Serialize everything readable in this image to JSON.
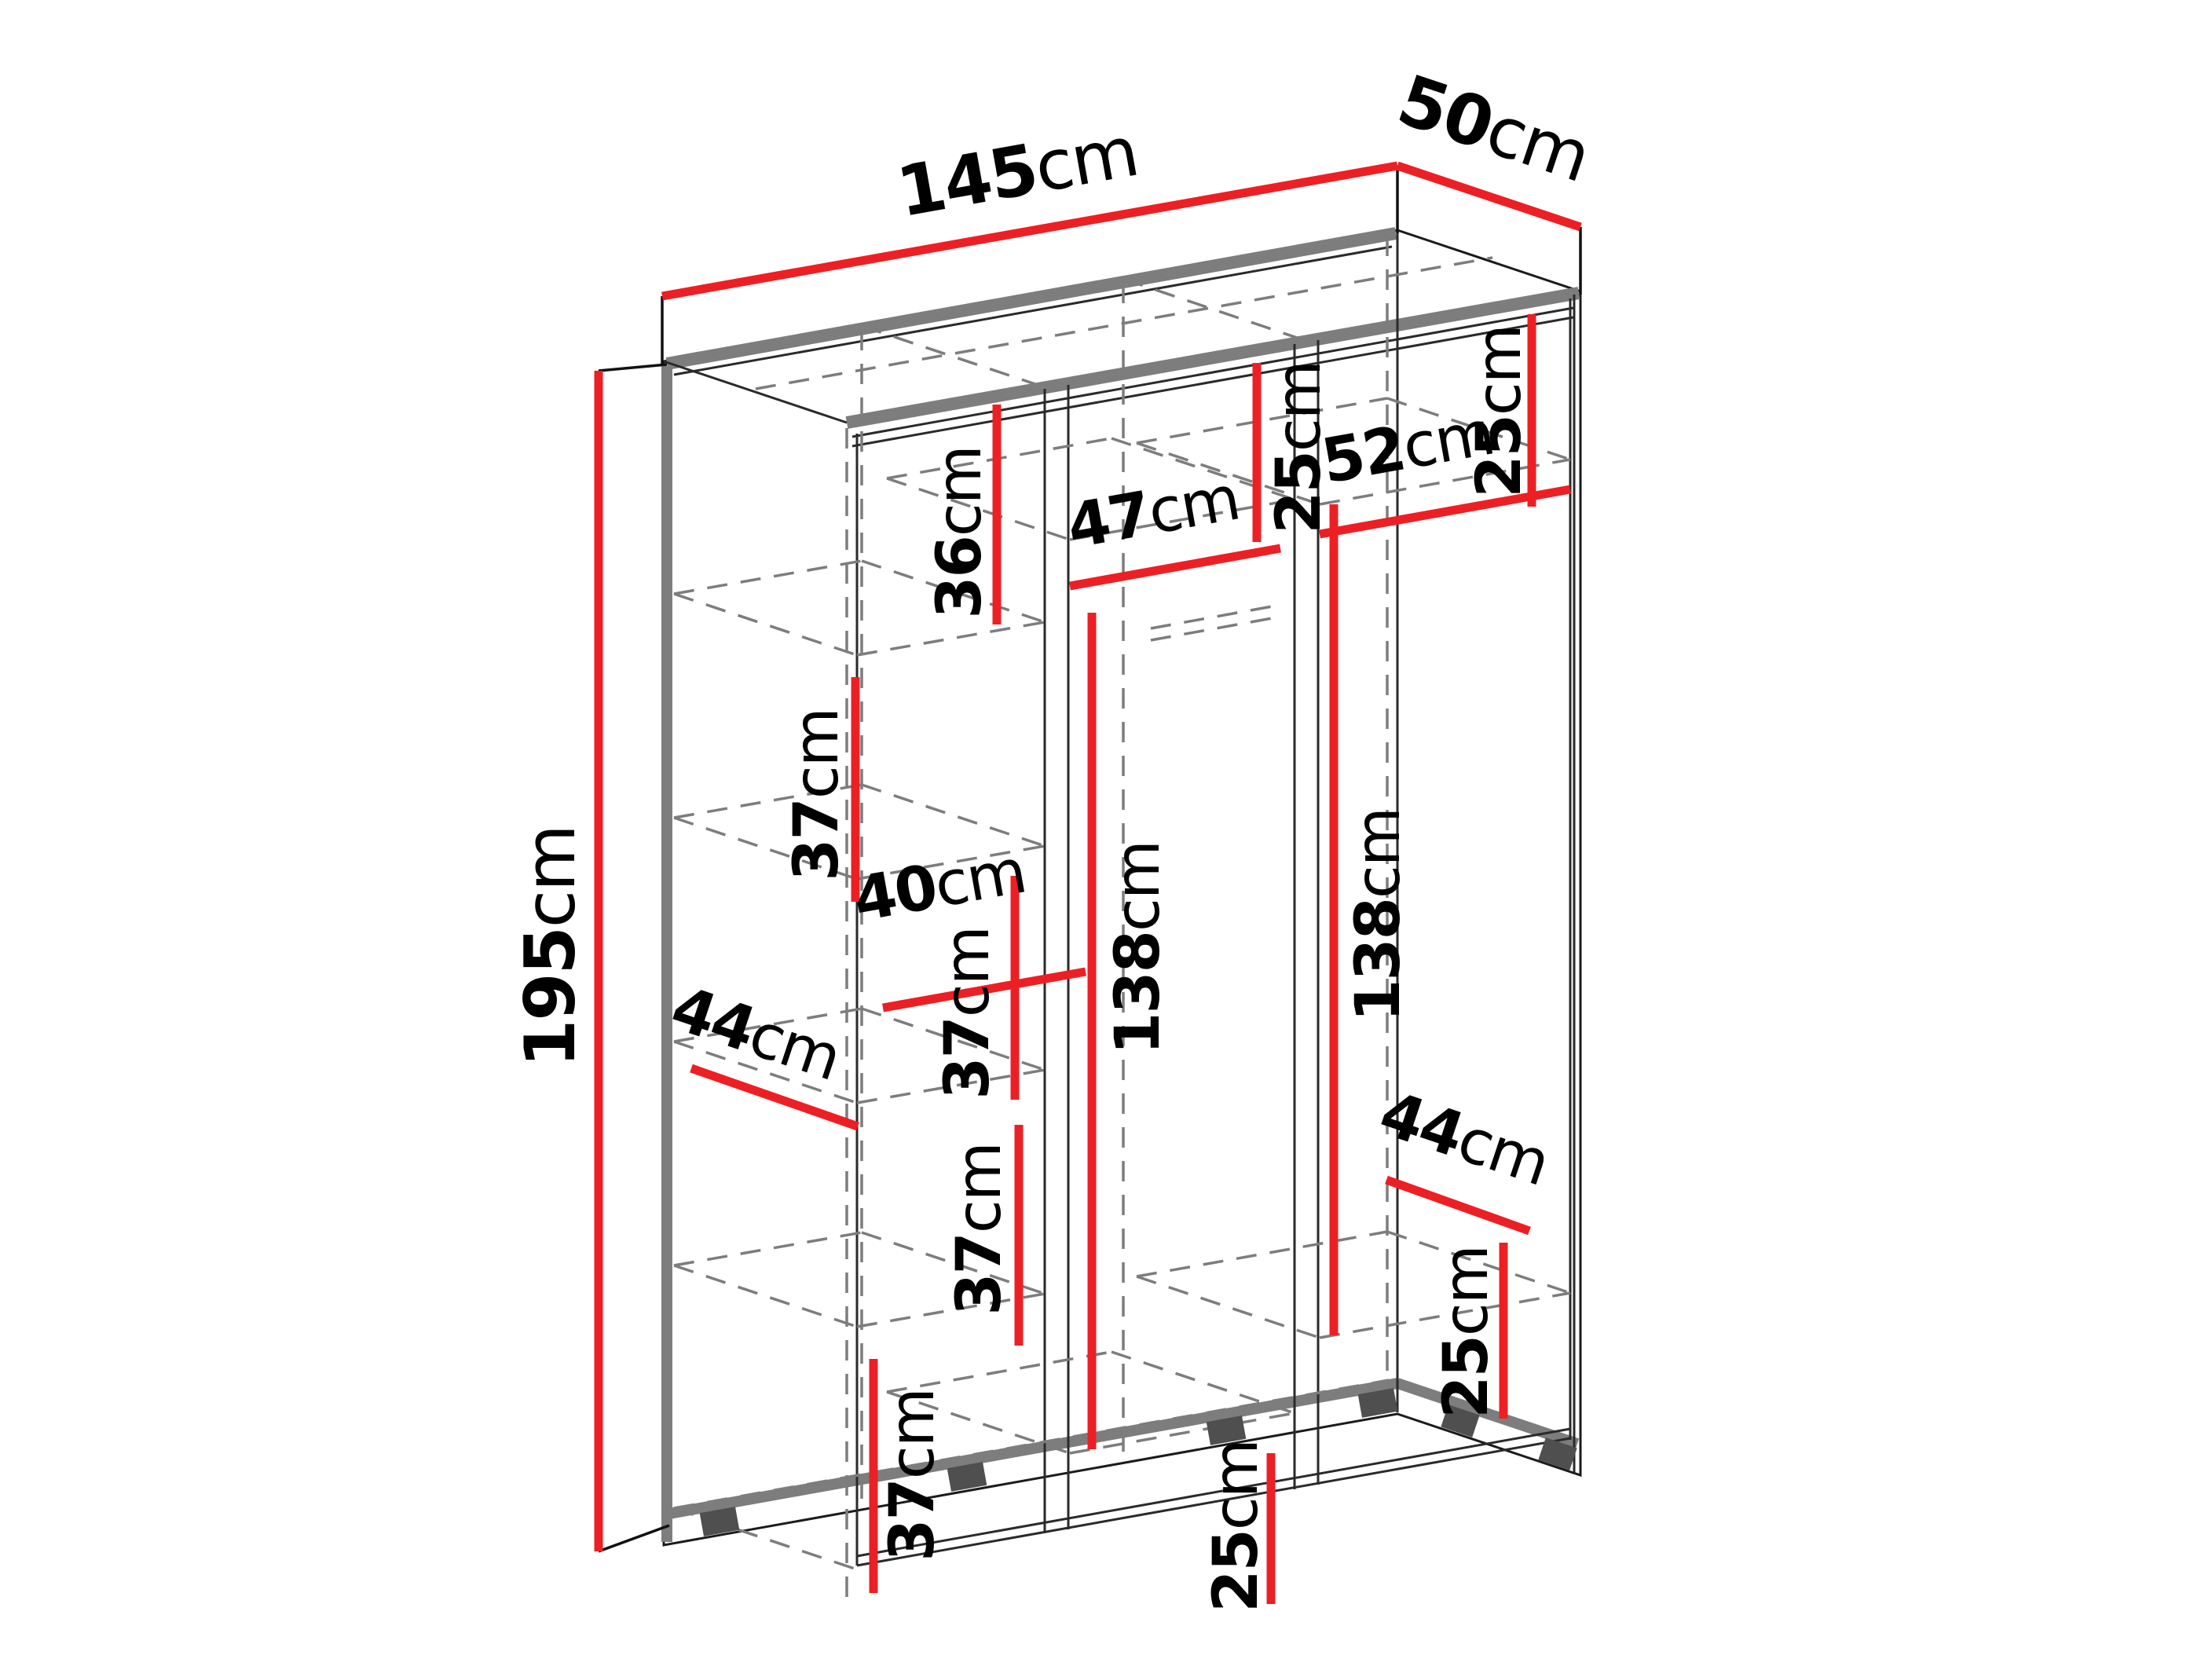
{
  "page": {
    "background": "#ffffff",
    "type": "furniture-dimension-diagram",
    "subject": "three-section wardrobe interior dimensions"
  },
  "colors": {
    "dimension_line": "#ec2024",
    "structure_edge": "#7d7d7d",
    "hidden_edge": "#7d7d7d",
    "outline": "#1b1b1b",
    "label_text": "#000000"
  },
  "diagram": {
    "overall": {
      "width": {
        "value": "145",
        "unit": "cm"
      },
      "depth": {
        "value": "50",
        "unit": "cm"
      },
      "height": {
        "value": "195",
        "unit": "cm"
      }
    },
    "left_column": {
      "compartment_top": {
        "value": "36",
        "unit": "cm"
      },
      "compartment_second": {
        "value": "37",
        "unit": "cm"
      },
      "compartment_third": {
        "value": "37",
        "unit": "cm"
      },
      "compartment_fourth": {
        "value": "37",
        "unit": "cm"
      },
      "compartment_bottom": {
        "value": "37",
        "unit": "cm"
      },
      "shelf_width": {
        "value": "40",
        "unit": "cm"
      },
      "shelf_depth": {
        "value": "44",
        "unit": "cm"
      }
    },
    "middle_column": {
      "width": {
        "value": "47",
        "unit": "cm"
      },
      "top_compartment": {
        "value": "25",
        "unit": "cm"
      },
      "hanging_height": {
        "value": "138",
        "unit": "cm"
      },
      "bottom_compartment": {
        "value": "25",
        "unit": "cm"
      }
    },
    "right_column": {
      "width": {
        "value": "52",
        "unit": "cm"
      },
      "top_compartment": {
        "value": "25",
        "unit": "cm"
      },
      "hanging_height": {
        "value": "138",
        "unit": "cm"
      },
      "shelf_depth": {
        "value": "44",
        "unit": "cm"
      },
      "bottom_compartment": {
        "value": "25",
        "unit": "cm"
      }
    }
  }
}
